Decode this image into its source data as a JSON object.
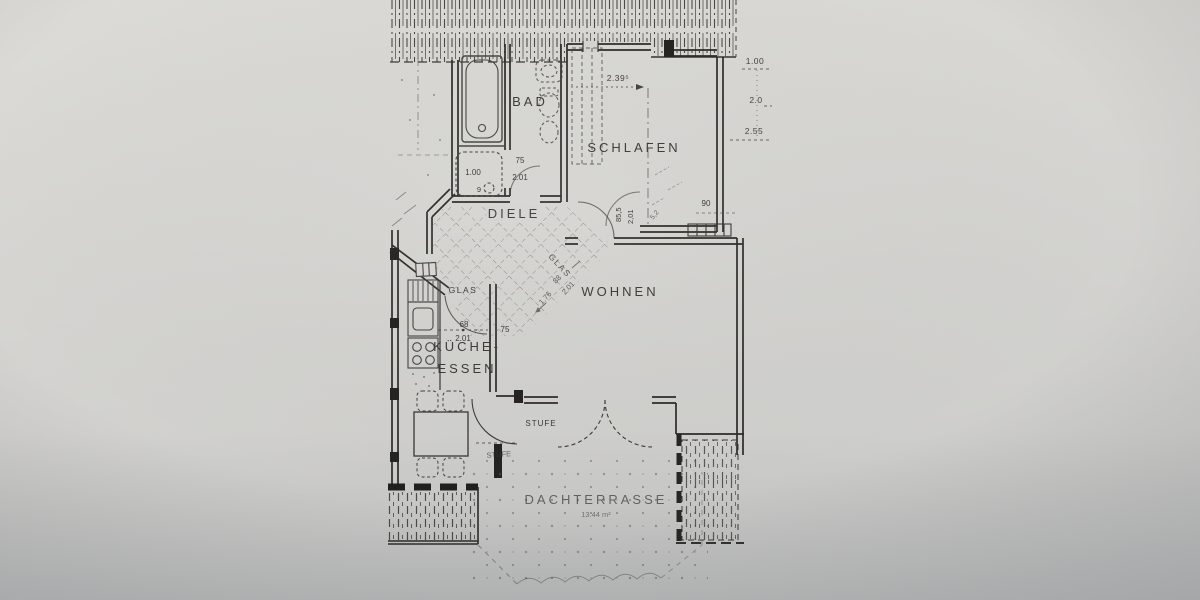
{
  "colors": {
    "paper": "#d7d6d2",
    "ink": "#34332f"
  },
  "rooms": {
    "bad": {
      "label": "BAD"
    },
    "schlafen": {
      "label": "SCHLAFEN"
    },
    "diele": {
      "label": "DIELE"
    },
    "wohnen": {
      "label": "WOHNEN"
    },
    "kueche_essen": {
      "label_line1": "KÜCHE-",
      "label_line2": "ESSEN"
    },
    "dachterrasse": {
      "label": "DACHTERRASSE",
      "area": "13.44 m²"
    }
  },
  "annotations": {
    "glas_kueche": "GLAS",
    "glas_wohnen": "GLAS",
    "stufe_door": "STUFE",
    "stufe_step": "STUFE",
    "dim_schlafen_width": "2.39⁵",
    "dim_right_top": "1.00",
    "dim_right_mid": "2.0",
    "dim_right_bottom": "2.55",
    "dim_shower": "1.00",
    "dim_shower_drain": "9",
    "dim_bad_door_width": "75",
    "dim_bad_door_height": "2.01",
    "dim_kueche_door_width": "68",
    "dim_kueche_door_height": "2.01",
    "dim_kueche_wall": "75",
    "dim_wohnen_door_width": "85,5",
    "dim_wohnen_door_height": "2,01",
    "dim_wohnen_diag_a": "88",
    "dim_wohnen_diag_b": "2.01",
    "dim_wohnen_diag_c": "1.76",
    "dim_diele_diag": "5,2",
    "dim_radiator": "90"
  }
}
